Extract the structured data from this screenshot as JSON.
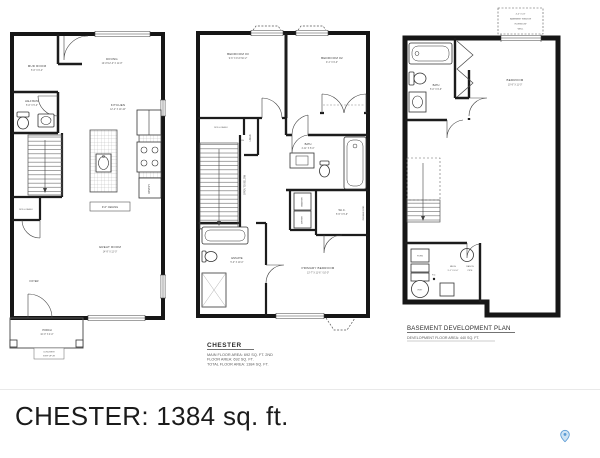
{
  "footer": {
    "title": "CHESTER: 1384 sq. ft."
  },
  "plan1": {
    "mud_room": "MUD ROOM",
    "mud_room_dim": "5'-6\" X 6'-4\"",
    "dining": "DINING",
    "dining_dim": "10'-0\"/12'-0\" X 11'-8\"",
    "half_bath": "HALF BATH",
    "half_bath_dim": "5'-6\" X 5'-0\"",
    "kitchen": "KITCHEN",
    "kitchen_dim": "12'-2\" X 10'-10\"",
    "ceiling": "9'-0\" CEILING",
    "great_room": "GREAT ROOM",
    "great_room_dim": "14'-9\" X 12'-0\"",
    "rod_shelf": "ROD & SHELF",
    "pantry": "PANTRY",
    "foyer": "FOYER",
    "porch": "PORCH",
    "porch_dim": "10'-0\" X 4'-0\"",
    "concrete": "CONCRETE",
    "step_up": "STEP UP 2R"
  },
  "plan2": {
    "bedroom3": "BEDROOM #3",
    "bedroom3_dim": "9'-6\" X 9'-6\"/10'-2\"",
    "bedroom2": "BEDROOM #2",
    "bedroom2_dim": "9'-1\" X 9'-0\"",
    "rod_shelf": "ROD & SHELF",
    "linen": "LINEN",
    "dn": "DN",
    "bath": "BATH",
    "bath_dim": "4'-11\" X 5'-0\"",
    "open_to_below": "OPEN TO BELOW",
    "washer": "WASHER",
    "dryer": "DRYER",
    "wic": "W.I.C.",
    "wic_dim": "5'-5\" X 5'-6\"",
    "double_rod": "DOUBLE ROD",
    "ensuite": "ENSUITE",
    "ensuite_dim": "5'-0\" X 10'-0\"",
    "primary_bedroom": "PRIMARY BEDROOM",
    "primary_bedroom_dim": "13'-7\" X 11'-6\" / 10'-0\"",
    "title": "CHESTER",
    "area_line1": "MAIN FLOOR AREA: 692 SQ. FT. 2ND",
    "area_line2": "FLOOR AREA: 692 SQ. FT.",
    "area_line3": "TOTAL FLOOR AREA: 1384 SQ. FT."
  },
  "plan3": {
    "window_note": [
      "4'-0\" X 24\"",
      "BASEMENT WINDOW",
      "IN WINDOW",
      "WELL"
    ],
    "bedroom": "BEDROOM",
    "bedroom_dim": "10'-9\" X 11'-0\"",
    "bath": "BATH",
    "bath_dim": "5'-0\" X 9'-6\"",
    "mech_name": "MECH",
    "mech_dim": "9'-1\" X 6'-6\"",
    "radon1": "RADON",
    "radon2": "PIPE",
    "furn": "FURN",
    "hwt": "HWT",
    "fd": "F.D.",
    "title": "BASEMENT DEVELOPMENT PLAN",
    "subtitle": "DEVELOPMENT FLOOR AREA: 440 SQ. FT."
  }
}
